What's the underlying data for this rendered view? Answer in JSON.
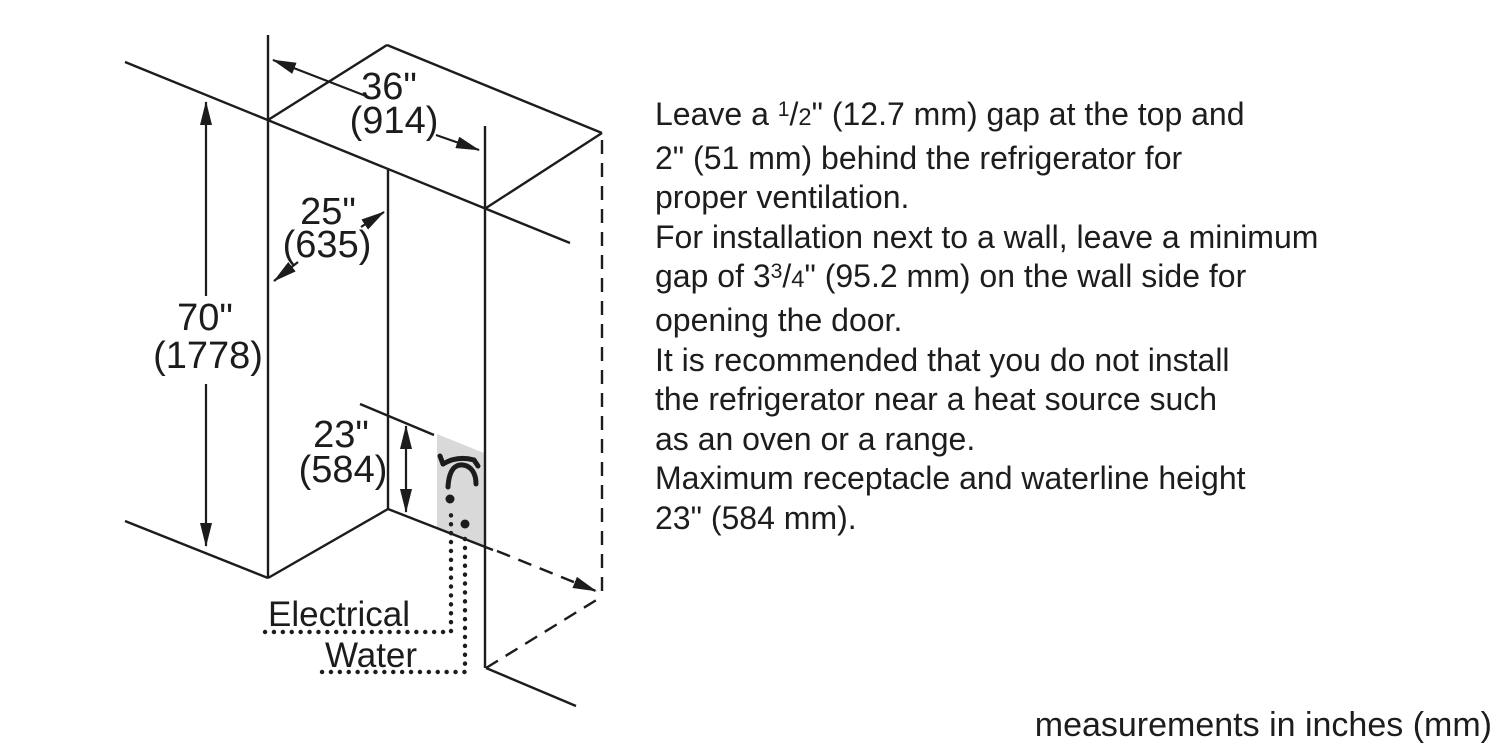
{
  "diagram": {
    "dimensions": {
      "width": {
        "inches": "36\"",
        "mm": "(914)"
      },
      "depth": {
        "inches": "25\"",
        "mm": "(635)"
      },
      "height": {
        "inches": "70\"",
        "mm": "(1778)"
      },
      "receptacle_height": {
        "inches": "23\"",
        "mm": "(584)"
      }
    },
    "labels": {
      "electrical": "Electrical",
      "water": "Water"
    },
    "icons": [
      "faucet-icon",
      "electrical-outlet-dot",
      "water-connection-dot"
    ],
    "colors": {
      "line": "#1c1c1c",
      "utility_panel": "#d9d9d9",
      "background": "#ffffff"
    }
  },
  "instructions": {
    "lines": [
      [
        {
          "t": "Leave a "
        },
        {
          "t": "1",
          "sup": true
        },
        {
          "t": "/"
        },
        {
          "t": "2",
          "small": true
        },
        {
          "t": "\" (12.7 mm) gap at the top and"
        }
      ],
      [
        {
          "t": "2\" (51 mm) behind the refrigerator for"
        }
      ],
      [
        {
          "t": "proper ventilation."
        }
      ],
      [
        {
          "t": "For installation next to a wall, leave a minimum"
        }
      ],
      [
        {
          "t": "gap of 3"
        },
        {
          "t": "3",
          "sup": true
        },
        {
          "t": "/"
        },
        {
          "t": "4",
          "small": true
        },
        {
          "t": "\" (95.2 mm) on the wall side for"
        }
      ],
      [
        {
          "t": "opening the door."
        }
      ],
      [
        {
          "t": "It is recommended that you do not install"
        }
      ],
      [
        {
          "t": "the refrigerator near a heat source such"
        }
      ],
      [
        {
          "t": "as an oven or a range."
        }
      ],
      [
        {
          "t": "Maximum receptacle and waterline height"
        }
      ],
      [
        {
          "t": "23\" (584 mm)."
        }
      ]
    ]
  },
  "footer": {
    "note": "measurements in inches (mm)"
  }
}
